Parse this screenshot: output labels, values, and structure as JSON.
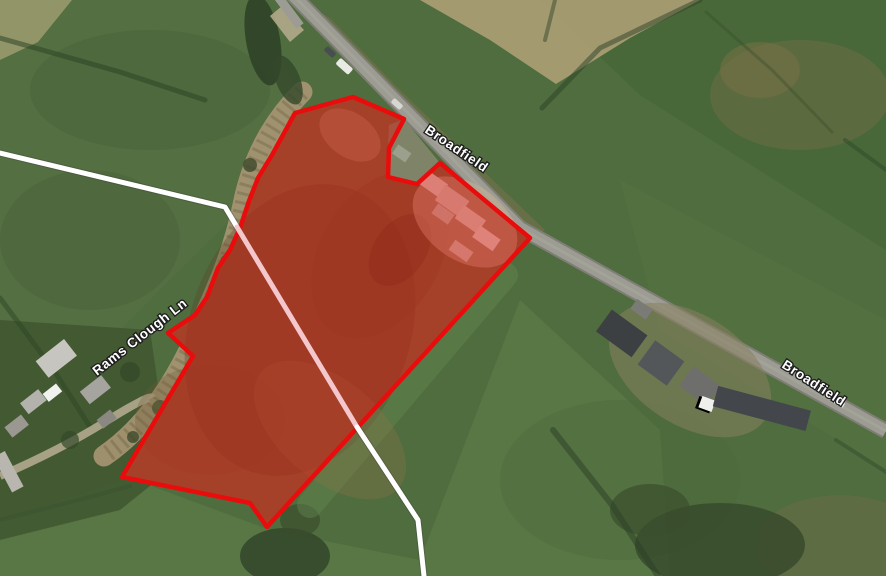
{
  "map": {
    "view": "satellite-aerial",
    "labels": [
      {
        "id": "road-label-top",
        "text": "Broadfield"
      },
      {
        "id": "road-label-right",
        "text": "Broadfield"
      },
      {
        "id": "lane-label",
        "text": "Rams Clough Ln"
      }
    ],
    "overlay": {
      "site_boundary_color": "#e90c0c",
      "site_fill_color": "rgba(226,12,8,0.42)",
      "footpath_color": "#ffffff",
      "footpath_through_site_color": "#f3c7cb"
    }
  }
}
